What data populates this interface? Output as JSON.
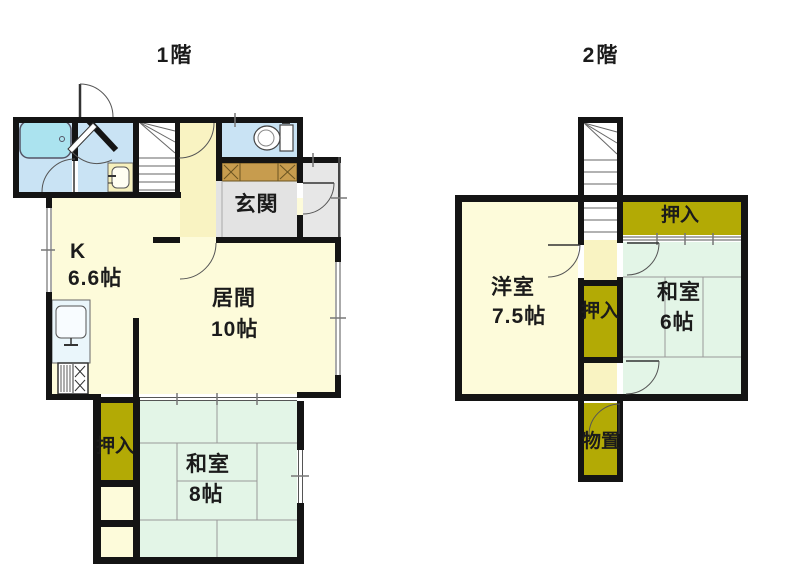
{
  "floor1": {
    "title": "1階",
    "rooms": {
      "kitchen": {
        "label": "K",
        "size": "6.6帖"
      },
      "living": {
        "label": "居間",
        "size": "10帖"
      },
      "entrance": {
        "label": "玄関"
      },
      "closet": {
        "label": "押入"
      },
      "washitsu": {
        "label": "和室",
        "size": "8帖"
      }
    }
  },
  "floor2": {
    "title": "2階",
    "rooms": {
      "western": {
        "label": "洋室",
        "size": "7.5帖"
      },
      "closet_center": {
        "label": "押入"
      },
      "closet_top": {
        "label": "押入"
      },
      "washitsu": {
        "label": "和室",
        "size": "6帖"
      },
      "storage": {
        "label": "物置"
      }
    }
  },
  "colors": {
    "wall": "#141414",
    "room_yellow": "#fdfbda",
    "hall_yellow": "#f9f3c2",
    "tatami_green": "#e3f5e7",
    "wet_blue": "#c9e3f4",
    "bathtub": "#abe3ef",
    "closet_olive": "#b3aa05",
    "entrance_gray": "#e3e3e3",
    "porch_gray": "#e7e7e7",
    "cabinet_tan": "#c79c4e",
    "line_gray": "#555555",
    "tatami_line": "#9aa89c"
  }
}
